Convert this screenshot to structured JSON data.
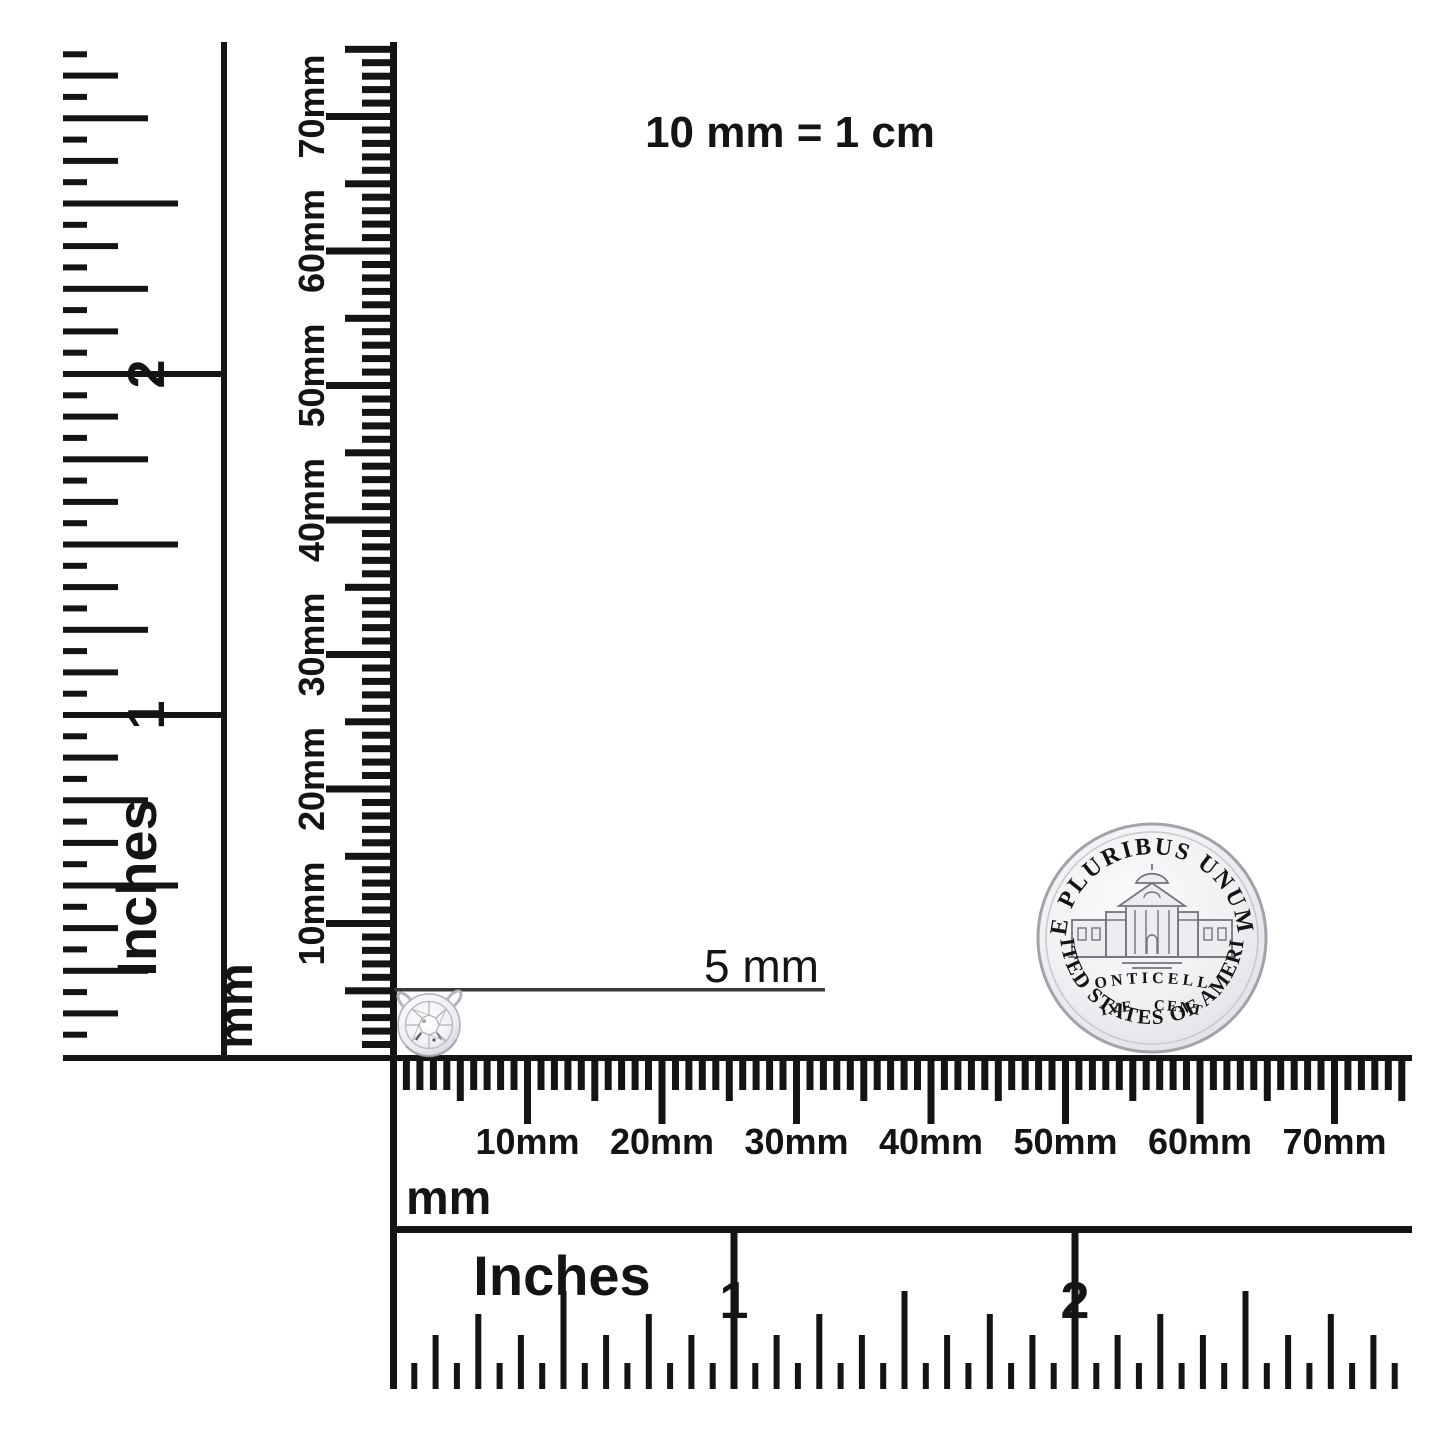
{
  "title": "10 mm = 1 cm",
  "measurement": {
    "label": "5 mm"
  },
  "rulers": {
    "inch_vertical": {
      "unit": "Inches",
      "labels": [
        "1",
        "2"
      ]
    },
    "mm_vertical": {
      "unit": "mm",
      "labels": [
        "10mm",
        "20mm",
        "30mm",
        "40mm",
        "50mm",
        "60mm",
        "70mm"
      ]
    },
    "mm_horizontal": {
      "unit": "mm",
      "labels": [
        "10mm",
        "20mm",
        "30mm",
        "40mm",
        "50mm",
        "60mm",
        "70mm"
      ]
    },
    "inch_horizontal": {
      "unit": "Inches",
      "labels": [
        "1",
        "2"
      ]
    }
  },
  "coin": {
    "legend_top": "E PLURIBUS UNUM",
    "building_label": "MONTICELLO",
    "denomination": "FIVE CENTS",
    "legend_bottom": "UNITED STATES OF AMERICA"
  },
  "icons": {
    "pendant": "round-diamond-bezel-pendant-icon",
    "coin": "us-nickel-reverse-icon"
  },
  "colors": {
    "ink": "#141414",
    "indicator_line": "#3a3a3a",
    "coin_silver": "#e9e9ed",
    "coin_engraving": "#5d5d66",
    "metal_light": "#f2f2f5",
    "metal_shade": "#bdbdc6"
  }
}
